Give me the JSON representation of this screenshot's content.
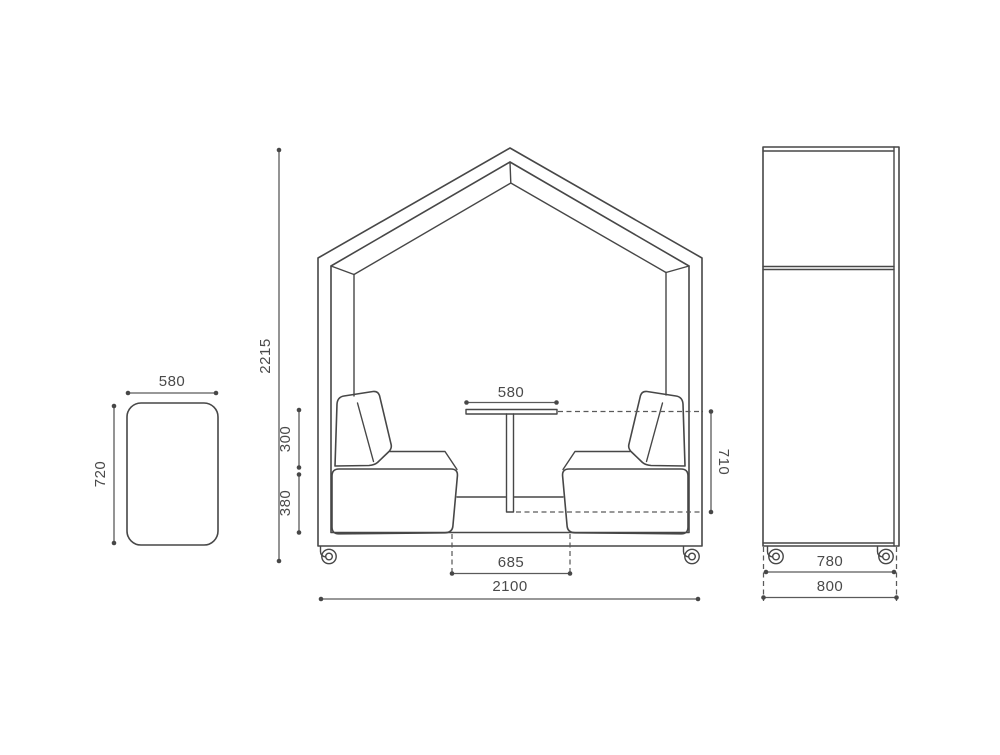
{
  "drawing": {
    "title": "meeting-pod-dimension-drawing",
    "background": "#ffffff",
    "line_color": "#474747",
    "text_color": "#4a4a4a"
  },
  "dims": {
    "top_view": {
      "width": "580",
      "depth": "720"
    },
    "front": {
      "total_height": "2215",
      "total_width": "2100",
      "backrest_height": "300",
      "seat_height": "380",
      "table_width": "580",
      "table_height": "710",
      "seat_gap": "685"
    },
    "side": {
      "wheelbase_width": "780",
      "depth": "800"
    }
  }
}
